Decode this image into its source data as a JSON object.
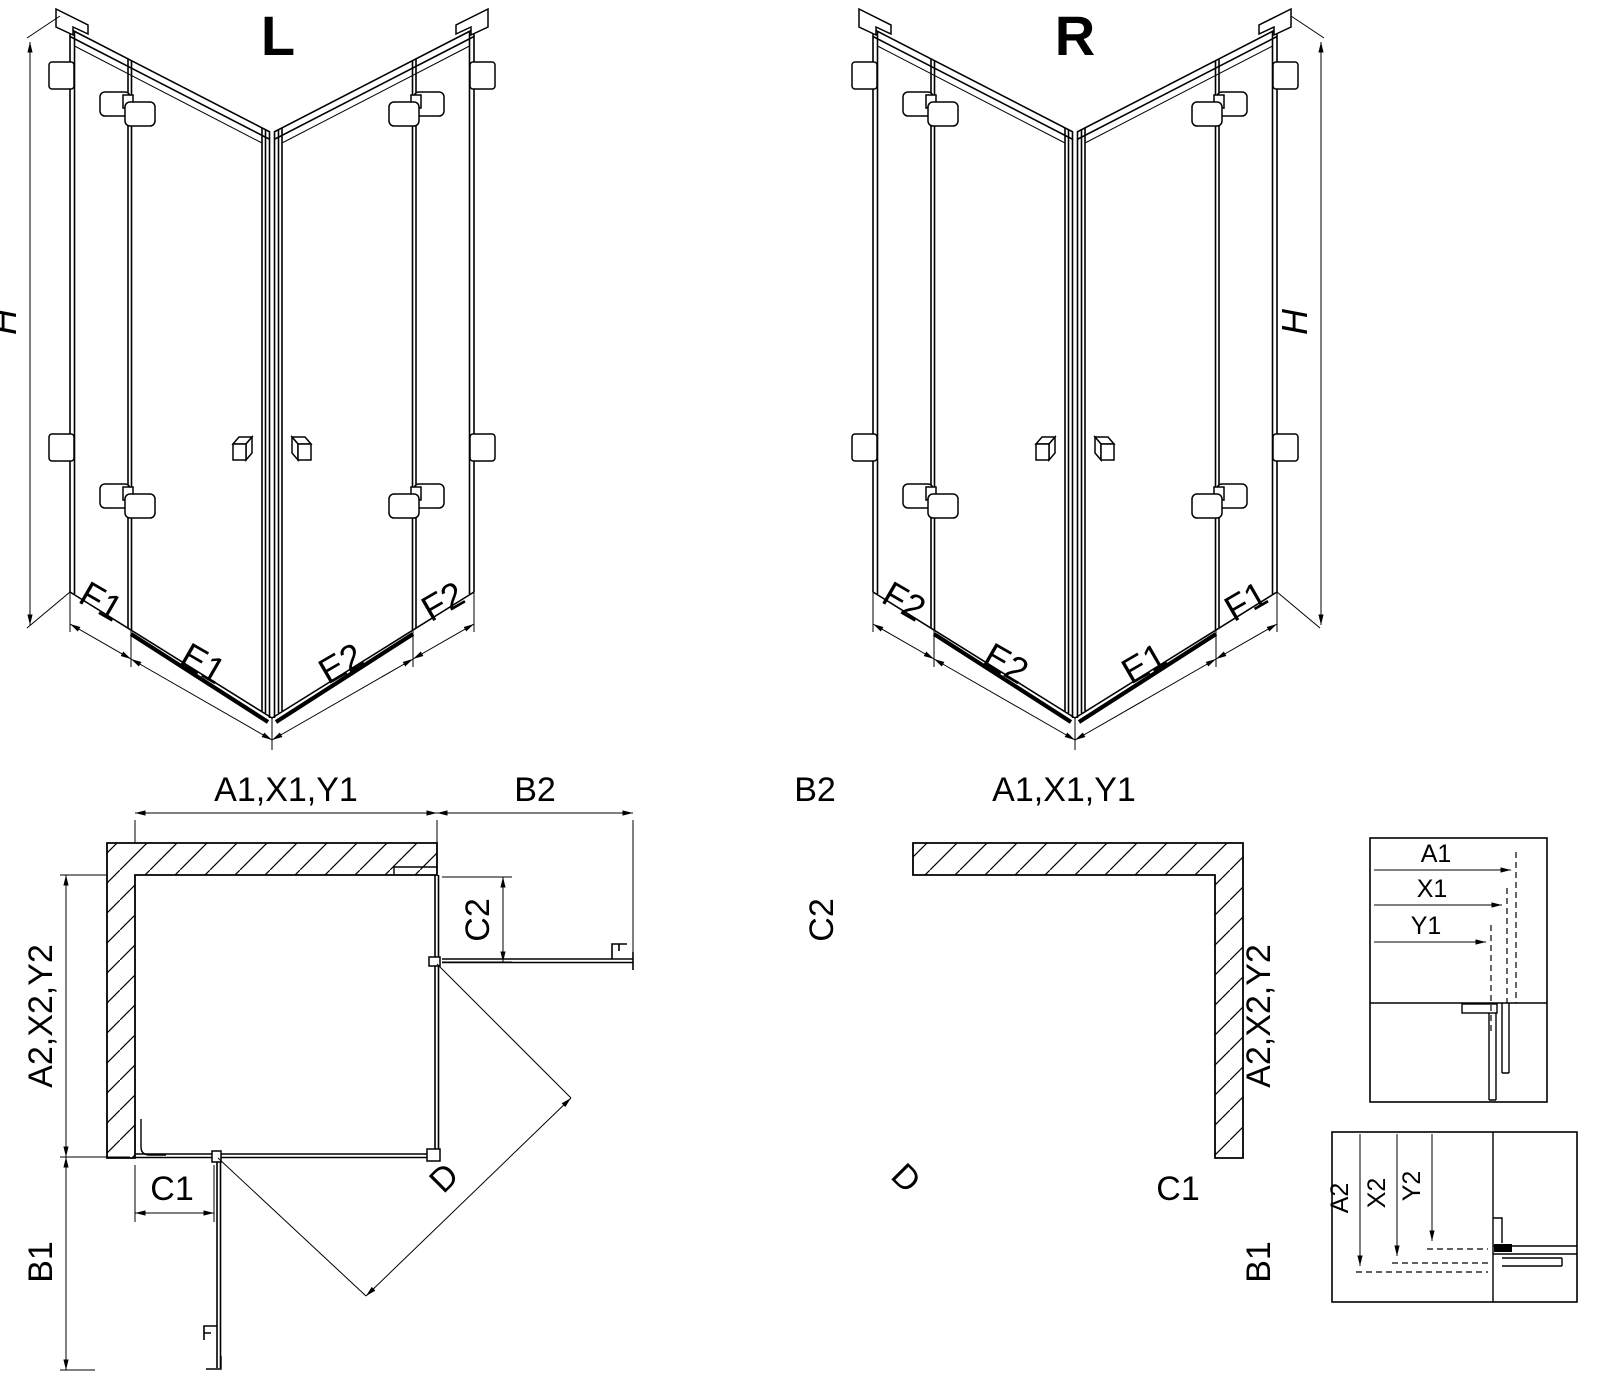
{
  "colors": {
    "line": "#000000",
    "background": "#ffffff"
  },
  "views": {
    "iso_left": {
      "title": "L",
      "height_label": "H",
      "bottom_labels": [
        "F1",
        "E1",
        "E2",
        "F2"
      ]
    },
    "iso_right": {
      "title": "R",
      "height_label": "H",
      "bottom_labels": [
        "F2",
        "E2",
        "E1",
        "F1"
      ]
    },
    "plan_left": {
      "width_label": "A1,X1,Y1",
      "side_open_label": "B2",
      "side_fixed_label": "C2",
      "depth_label": "A2,X2,Y2",
      "bottom_fixed_label": "C1",
      "bottom_open_label": "B1",
      "diagonal_label": "D"
    },
    "plan_right": {
      "width_label": "A1,X1,Y1",
      "side_open_label": "B2",
      "side_fixed_label": "C2",
      "depth_label": "A2,X2,Y2",
      "bottom_fixed_label": "C1",
      "bottom_open_label": "B1",
      "diagonal_label": "D"
    },
    "detail_width": {
      "labels": [
        "A1",
        "X1",
        "Y1"
      ]
    },
    "detail_depth": {
      "labels": [
        "A2",
        "X2",
        "Y2"
      ]
    }
  }
}
